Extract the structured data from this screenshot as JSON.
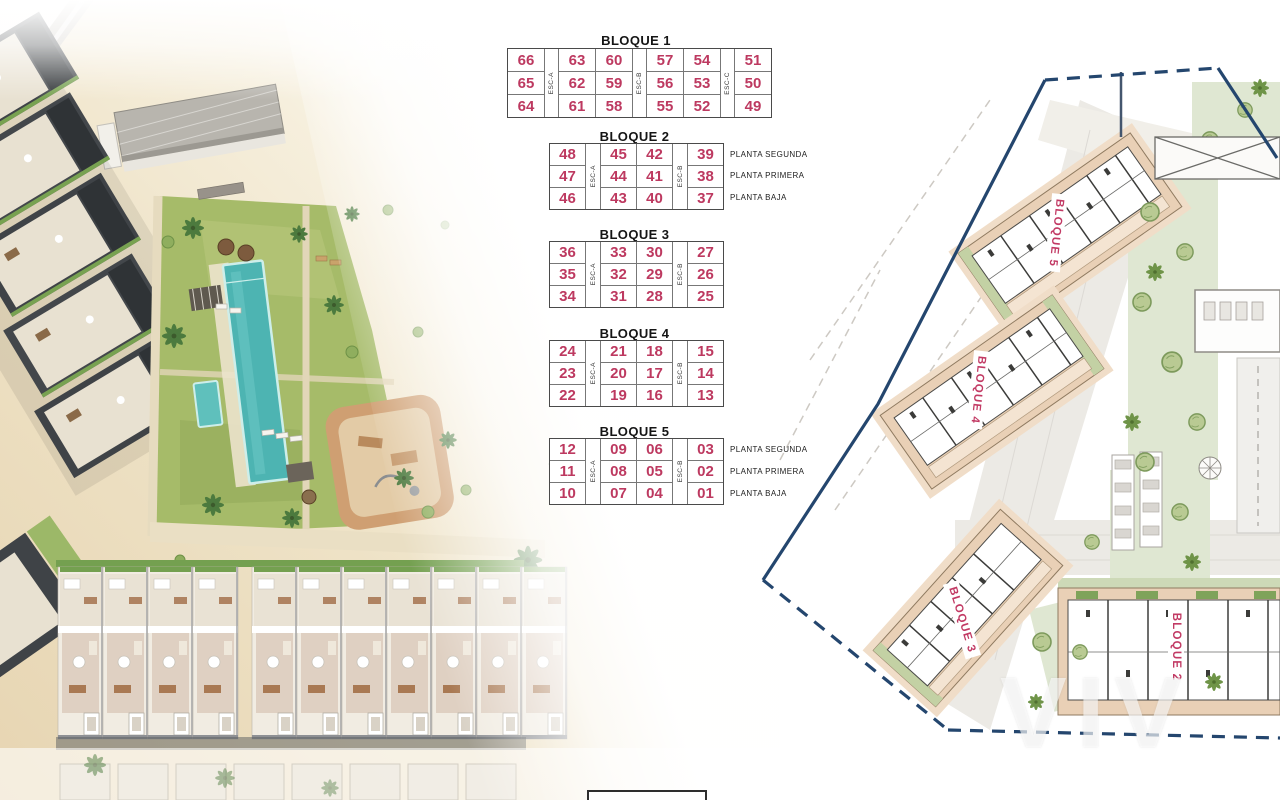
{
  "colors": {
    "unit_number_pink": "#bd3960",
    "table_border_gray": "#4a4a4a",
    "boundary_navy": "#24466e",
    "pool_turquoise": "#4db4b2",
    "sand_beige": "#ecdfc2",
    "garden_green": "#a6bb69",
    "plan_building_tan": "#e9d0b6",
    "plan_garden_green": "#dfe7d2"
  },
  "tables": [
    {
      "title": "BLOQUE 1",
      "esc_labels": [
        "ESC-A",
        "ESC-B",
        "ESC-C"
      ],
      "rows": [
        [
          "66",
          "63",
          "60",
          "57",
          "54",
          "51"
        ],
        [
          "65",
          "62",
          "59",
          "56",
          "53",
          "50"
        ],
        [
          "64",
          "61",
          "58",
          "55",
          "52",
          "49"
        ]
      ]
    },
    {
      "title": "BLOQUE 2",
      "esc_labels": [
        "ESC-A",
        "ESC-B"
      ],
      "rows": [
        [
          "48",
          "45",
          "42",
          "39"
        ],
        [
          "47",
          "44",
          "41",
          "38"
        ],
        [
          "46",
          "43",
          "40",
          "37"
        ]
      ],
      "floor_labels": [
        "PLANTA SEGUNDA",
        "PLANTA PRIMERA",
        "PLANTA BAJA"
      ]
    },
    {
      "title": "BLOQUE 3",
      "esc_labels": [
        "ESC-A",
        "ESC-B"
      ],
      "rows": [
        [
          "36",
          "33",
          "30",
          "27"
        ],
        [
          "35",
          "32",
          "29",
          "26"
        ],
        [
          "34",
          "31",
          "28",
          "25"
        ]
      ]
    },
    {
      "title": "BLOQUE 4",
      "esc_labels": [
        "ESC-A",
        "ESC-B"
      ],
      "rows": [
        [
          "24",
          "21",
          "18",
          "15"
        ],
        [
          "23",
          "20",
          "17",
          "14"
        ],
        [
          "22",
          "19",
          "16",
          "13"
        ]
      ]
    },
    {
      "title": "BLOQUE 5",
      "esc_labels": [
        "ESC-A",
        "ESC-B"
      ],
      "rows": [
        [
          "12",
          "09",
          "06",
          "03"
        ],
        [
          "11",
          "08",
          "05",
          "02"
        ],
        [
          "10",
          "07",
          "04",
          "01"
        ]
      ],
      "floor_labels": [
        "PLANTA SEGUNDA",
        "PLANTA PRIMERA",
        "PLANTA BAJA"
      ]
    }
  ],
  "site_plan": {
    "block_labels": [
      {
        "text": "BLOQUE 5"
      },
      {
        "text": "BLOQUE 4"
      },
      {
        "text": "BLOQUE 3"
      },
      {
        "text": "BLOQUE 2"
      }
    ],
    "watermark": "VIV"
  }
}
